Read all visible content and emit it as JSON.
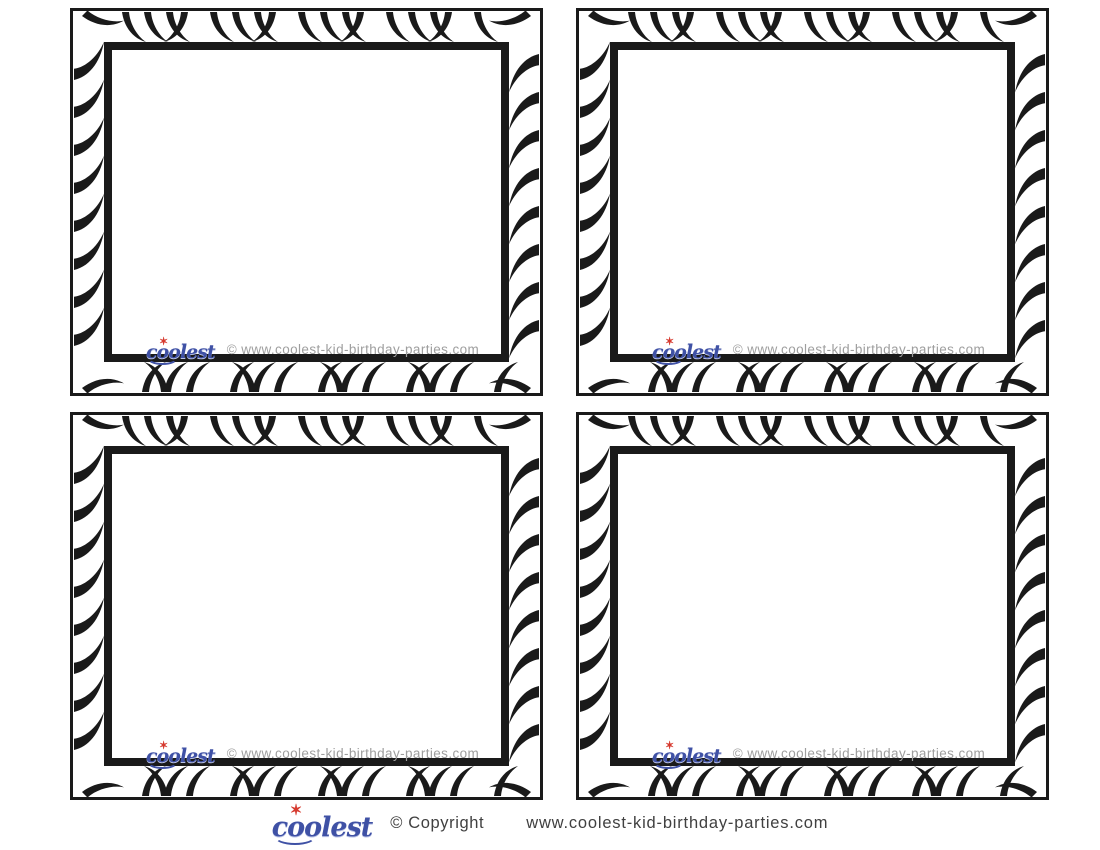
{
  "page": {
    "title": "Blank Zebra Print Thank You Cards Printable Sheet",
    "background_color": "#ffffff"
  },
  "colors": {
    "stripe_black": "#1a1a1a",
    "logo_blue": "#3f51a5",
    "logo_star_red": "#d63a2f",
    "watermark_gray": "#9e9e9e",
    "footer_text_gray": "#404040"
  },
  "cards": [
    {
      "watermark": {
        "logo_text": "coolest",
        "url_text": "© www.coolest-kid-birthday-parties.com"
      }
    },
    {
      "watermark": {
        "logo_text": "coolest",
        "url_text": "© www.coolest-kid-birthday-parties.com"
      }
    },
    {
      "watermark": {
        "logo_text": "coolest",
        "url_text": "© www.coolest-kid-birthday-parties.com"
      }
    },
    {
      "watermark": {
        "logo_text": "coolest",
        "url_text": "© www.coolest-kid-birthday-parties.com"
      }
    }
  ],
  "footer": {
    "logo_text": "coolest",
    "copyright_text": "© Copyright",
    "url_text": "www.coolest-kid-birthday-parties.com"
  }
}
